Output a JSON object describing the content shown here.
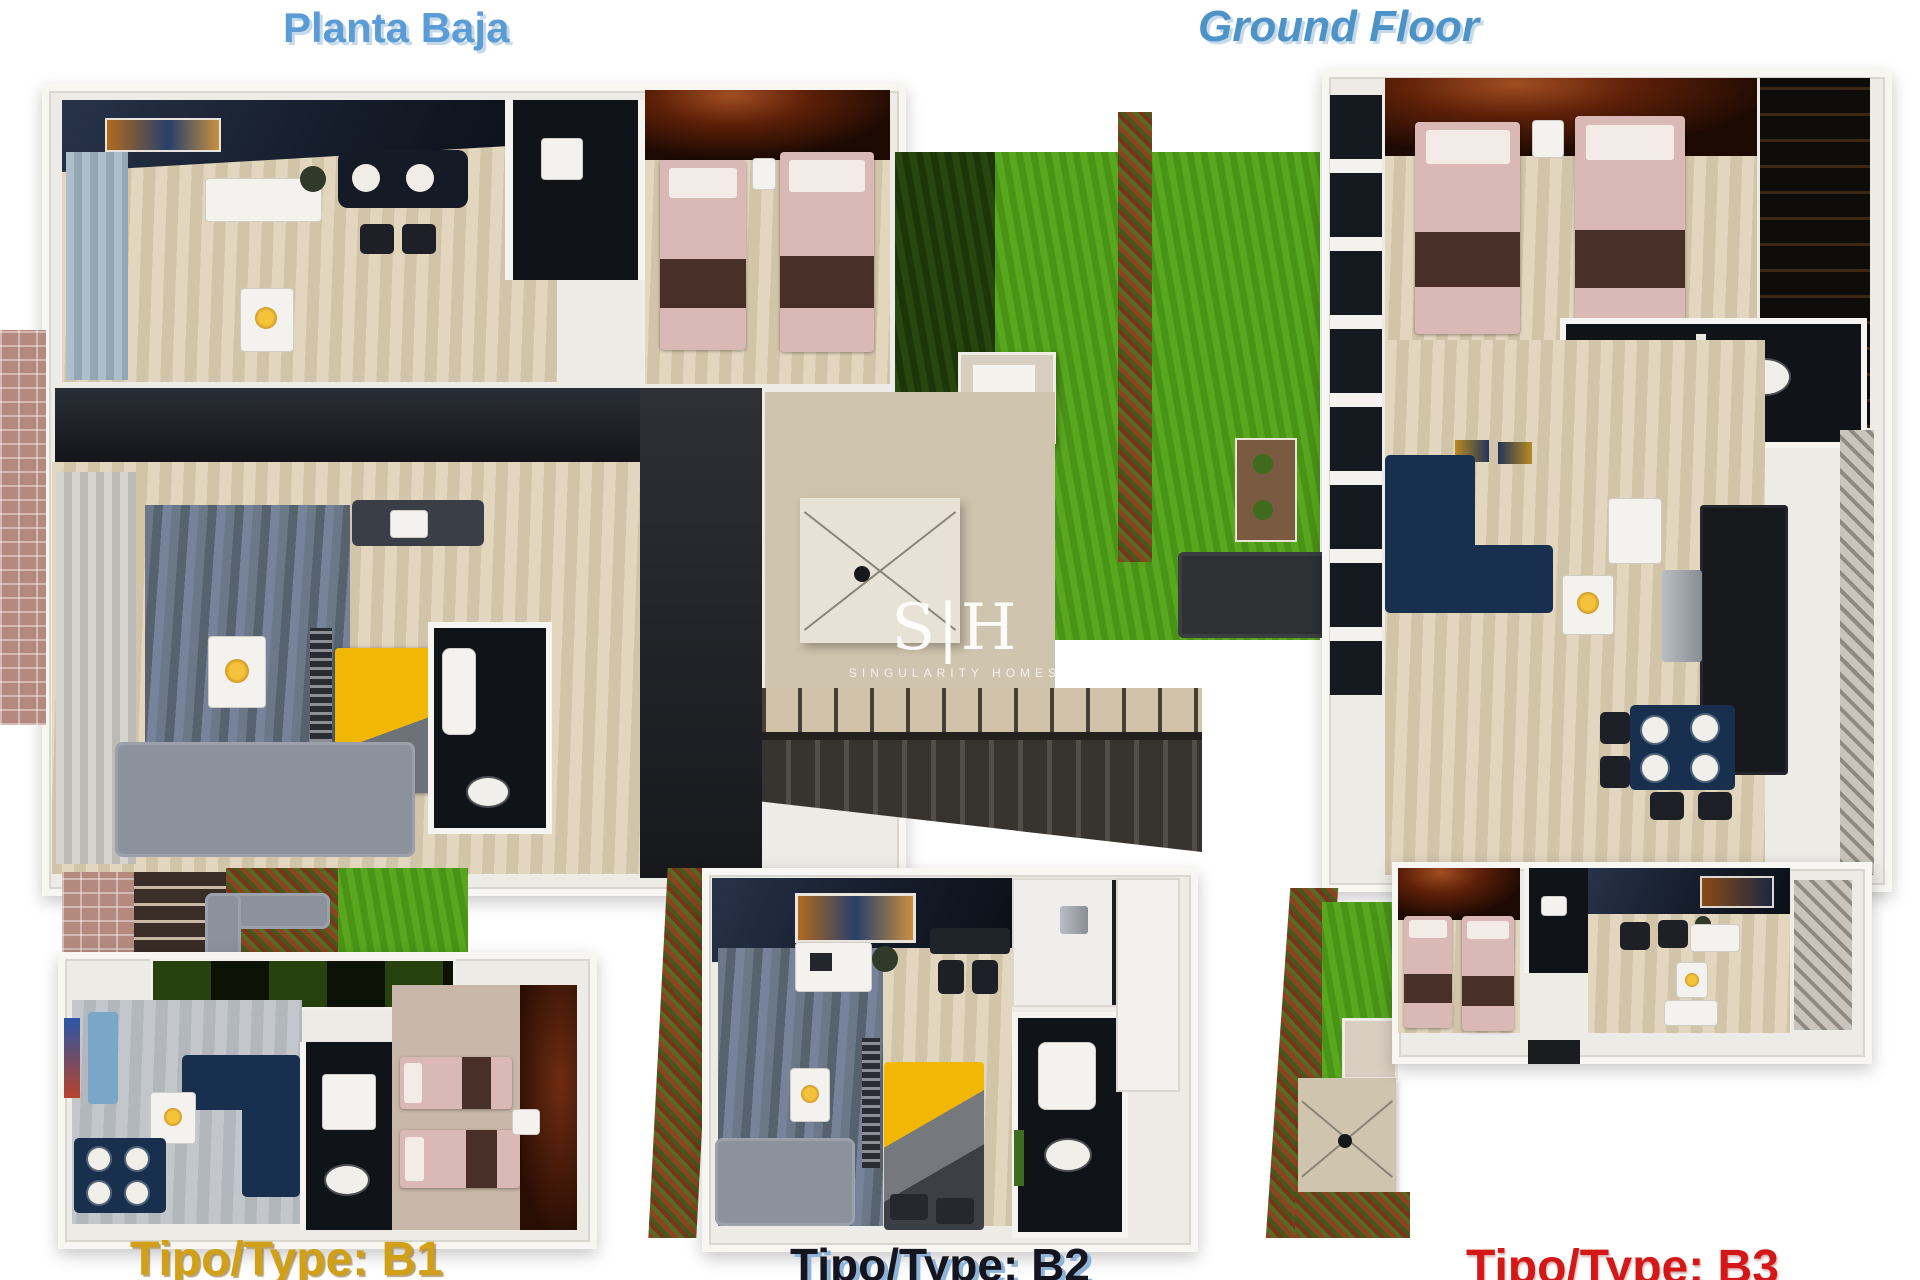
{
  "titles": {
    "left": "Planta Baja",
    "right": "Ground Floor"
  },
  "watermark": {
    "logo": "S|H",
    "subtitle": "SINGULARITY HOMES"
  },
  "plans": [
    {
      "label": "Tipo/Type: B1",
      "color": "#d2a017"
    },
    {
      "label": "Tipo/Type: B2",
      "color": "#15151f"
    },
    {
      "label": "Tipo/Type: B3",
      "color": "#d41717"
    }
  ],
  "palette": {
    "title_blue": "#5b9cd6",
    "wall_white": "#f7f6f3",
    "floor_beige": "#d8cbb2",
    "floor_grey": "#b8bcc2",
    "carpet_blue_grey": "#657382",
    "grass_green": "#52a01b",
    "hedge_autumn": "#8a4420",
    "bed_pink": "#d9b8b6",
    "bed_yellow": "#f0b400",
    "sofa_navy": "#18304e",
    "ceiling_dark_navy": "#151c2a",
    "ceiling_red_glow": "#a14e22"
  }
}
